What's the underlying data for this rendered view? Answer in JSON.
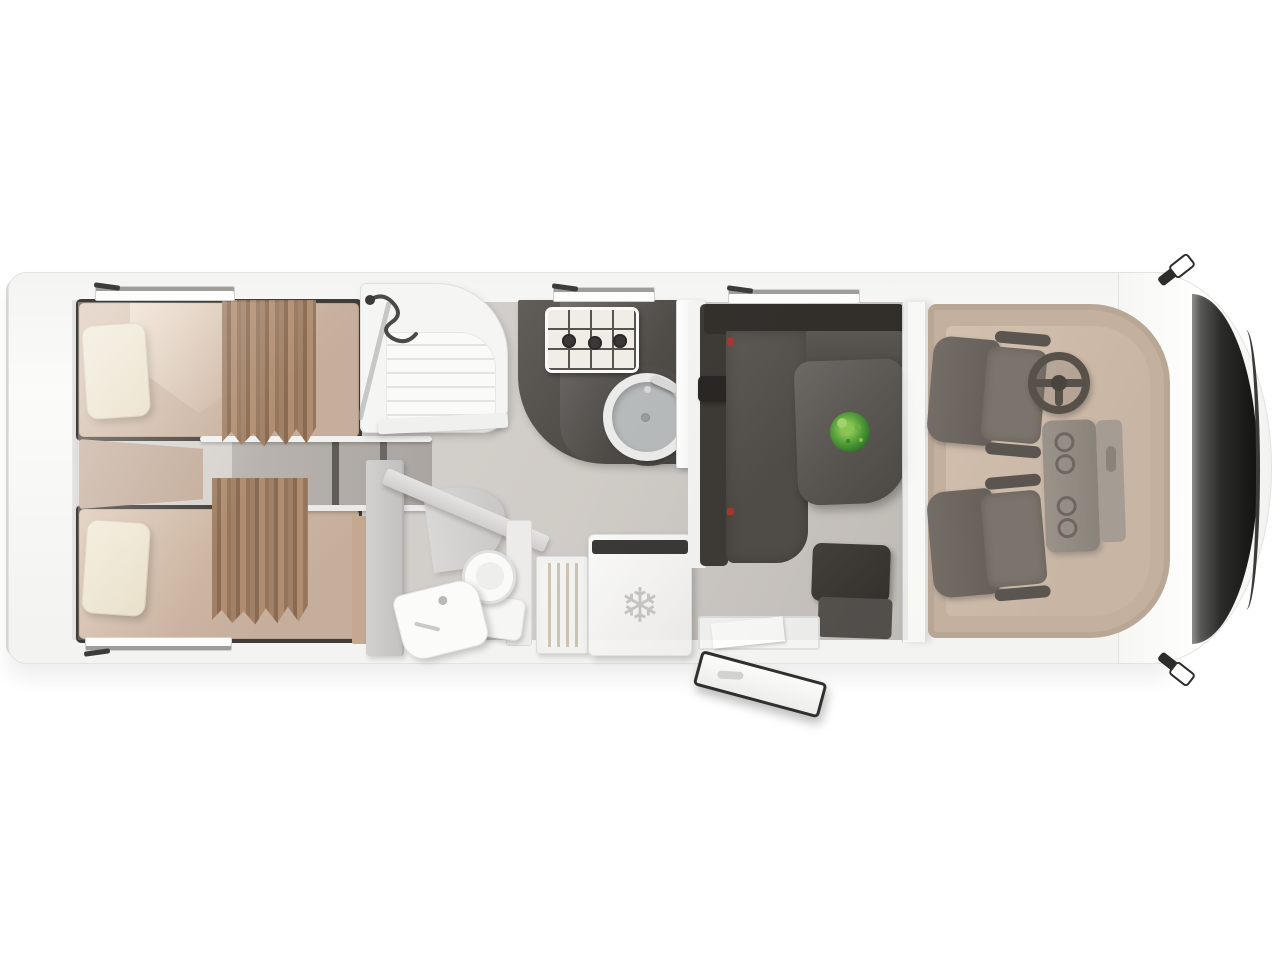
{
  "meta": {
    "title": "Motorhome floor plan - top-down cutaway view",
    "view": "top-down 3D render, front of vehicle on the right, rear on the left",
    "background_color": "#ffffff"
  },
  "vehicle": {
    "body_color": "#f6f6f4",
    "bumper_color": "#dcdcda",
    "windshield_color": "#1c1c1a",
    "floor_color": "#d3cfca",
    "mirrors": [
      "driver-mirror-top",
      "passenger-mirror-bottom"
    ],
    "windows": [
      "rear-bedroom-top-window",
      "kitchen-window",
      "dinette-window",
      "rear-bedroom-bottom-window"
    ]
  },
  "rooms": {
    "rear_bedroom": {
      "name": "rear twin bedroom",
      "beds": 2,
      "mattress_color": "#cdb6a3",
      "pillow_color": "#ece4cf",
      "curtain_color": "#96755a",
      "items": [
        "single-bed-top",
        "single-bed-bottom",
        "center-cushion",
        "pillow-top",
        "pillow-bottom",
        "privacy-curtain-top",
        "privacy-curtain-bottom",
        "center-steps",
        "wardrobe-door"
      ]
    },
    "shower_room": {
      "name": "shower cabin",
      "items": [
        "shower-tray",
        "shower-hose",
        "shower-glass-door",
        "shelf"
      ]
    },
    "kitchen": {
      "name": "kitchenette",
      "counter_color": "#524f4b",
      "hob_burners": 3,
      "items": [
        "kitchen-counter",
        "gas-hob",
        "round-sink",
        "faucet",
        "tall-cabinet"
      ]
    },
    "bathroom": {
      "name": "washroom",
      "items": [
        "toilet",
        "toilet-tank",
        "washbasin",
        "diagonal-partition",
        "wardrobe-panel"
      ]
    },
    "galley_storage": {
      "name": "pantry and refrigerator",
      "refrigerator": {
        "glyph": "❄",
        "glyph_name": "snowflake-icon",
        "glyph_color": "#c7c5c2"
      },
      "items": [
        "pantry-shelves",
        "refrigerator"
      ]
    },
    "dinette": {
      "name": "L-shaped dinette lounge",
      "sofa_color": "#514d48",
      "table_color": "#5b5753",
      "plant_color": "#57a33c",
      "items": [
        "l-sofa",
        "dinette-table",
        "table-plant",
        "side-seat",
        "entry-step",
        "entry-door-open"
      ]
    },
    "cab": {
      "name": "driver cab",
      "mat_color": "#c8b5a4",
      "seat_color": "#6e675f",
      "items": [
        "driver-seat",
        "passenger-seat",
        "steering-wheel",
        "center-console",
        "cup-holders",
        "dashboard",
        "windshield"
      ]
    }
  },
  "palette": {
    "wall_white": "#f6f6f4",
    "floor_gray": "#d3cfca",
    "dark_upholstery": "#4e4a46",
    "tan_mattress": "#cdb6a3",
    "brown_curtain": "#96755a",
    "cream_pillow": "#ece4cf",
    "cab_beige": "#c8b5a4",
    "accent_red": "#a8362f",
    "plant_green": "#57a33c"
  }
}
